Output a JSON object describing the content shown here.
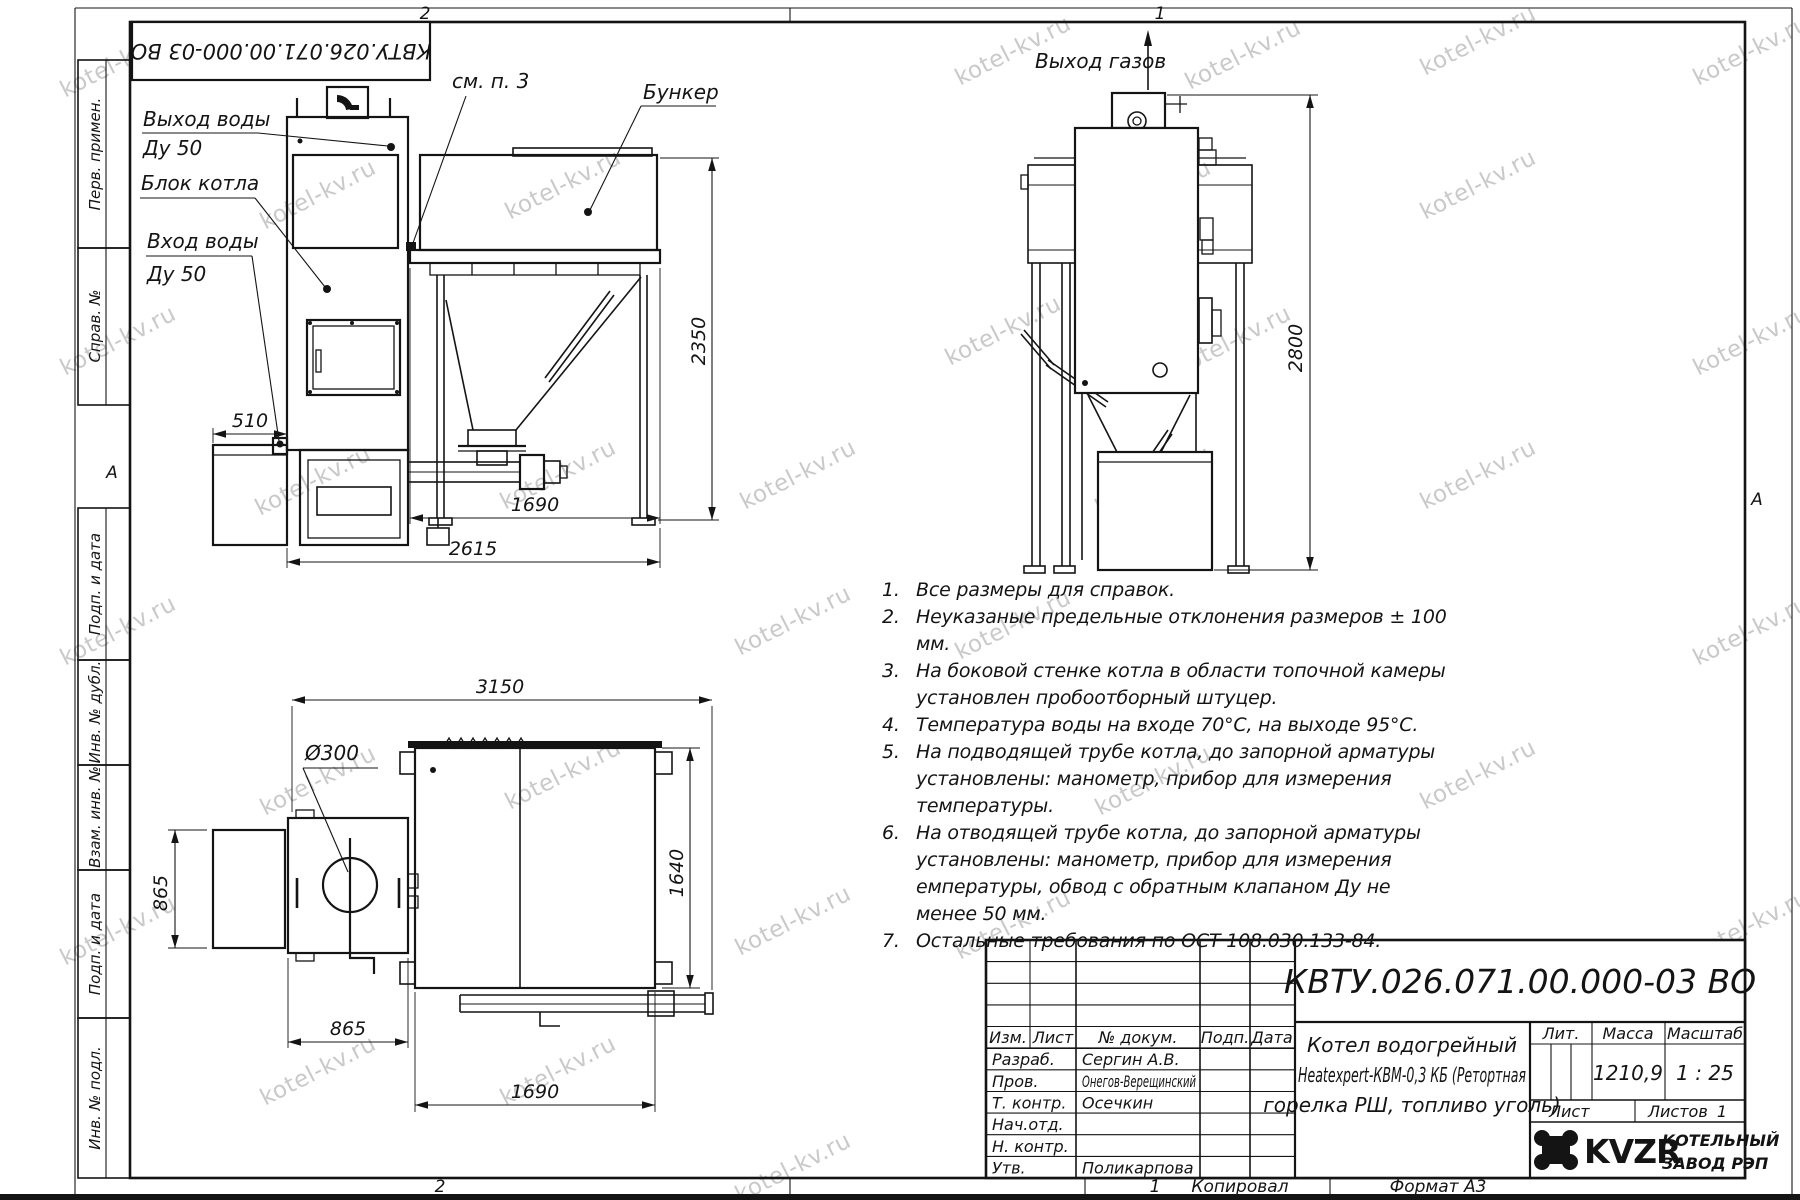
{
  "watermark": {
    "text": "kotel-kv.ru"
  },
  "sheet": {
    "zone_top_left": "2",
    "zone_top_right": "1",
    "zone_bottom_left": "2",
    "zone_bottom_right": "1",
    "fold_mark_left": "А",
    "fold_mark_right": "А",
    "copied": "Копировал",
    "format": "Формат А3",
    "doc_number_flipped": "КВТУ.026.071.00.000-03 ВО"
  },
  "margin_labels": {
    "perv_primen": "Перв. примен.",
    "sprav_no": "Справ. №",
    "podp_i_data_1": "Подп. и дата",
    "inv_no_dubl": "Инв. № дубл.",
    "vzam_inv_no": "Взам. инв. №",
    "podp_i_data_2": "Подп. и дата",
    "inv_no_podl": "Инв. № подл."
  },
  "front_view": {
    "water_out_line1": "Выход воды",
    "water_out_line2": "Ду 50",
    "boiler_block": "Блок котла",
    "water_in_line1": "Вход воды",
    "water_in_line2": "Ду 50",
    "see_note": "см. п. 3",
    "bunker": "Бункер",
    "dim_510": "510",
    "dim_1690": "1690",
    "dim_2615": "2615",
    "dim_2350": "2350"
  },
  "side_view": {
    "gas_out": "Выход газов",
    "dim_2800": "2800"
  },
  "plan_view": {
    "dia_300": "Ø300",
    "dim_3150": "3150",
    "dim_865_v": "865",
    "dim_865_h": "865",
    "dim_1690": "1690",
    "dim_1640": "1640"
  },
  "notes": {
    "items": [
      {
        "num": "1.",
        "text": "Все размеры для справок."
      },
      {
        "num": "2.",
        "text": "Неуказаные предельные отклонения размеров ± 100 мм."
      },
      {
        "num": "3.",
        "text": "На боковой стенке котла в области топочной камеры установлен пробоотборный штуцер."
      },
      {
        "num": "4.",
        "text": "Температура воды на входе 70°С, на выходе 95°С."
      },
      {
        "num": "5.",
        "text": "На подводящей трубе котла, до запорной арматуры установлены: манометр, прибор для измерения температуры."
      },
      {
        "num": "6.",
        "text": "На отводящей трубе котла, до запорной арматуры установлены: манометр, прибор для измерения емпературы, обвод с обратным клапаном Ду не менее 50 мм."
      },
      {
        "num": "7.",
        "text": "Остальные требования по ОСТ 108.030.133-84."
      }
    ]
  },
  "title_block": {
    "doc_number": "КВТУ.026.071.00.000-03 ВО",
    "name_line1": "Котел водогрейный",
    "name_line2": "Heatexpert-КВМ-0,3 КБ (Ретортная",
    "name_line3": "горелка РШ, топливо уголь)",
    "col_izm": "Изм.",
    "col_list": "Лист",
    "col_dokum": "№ докум.",
    "col_podp": "Подп.",
    "col_data": "Дата",
    "row_razrab": "Разраб.",
    "razrab_name": "Сергин А.В.",
    "row_prov": "Пров.",
    "prov_name": "Онегов-Верещинский",
    "row_tkontr": "Т. контр.",
    "tkontr_name": "Осечкин",
    "row_nachotd": "Нач.отд.",
    "row_nkontr": "Н. контр.",
    "row_utv": "Утв.",
    "utv_name": "Поликарпова",
    "lit_label": "Лит.",
    "massa_label": "Масса",
    "masshtab_label": "Масштаб",
    "massa_value": "1210,9",
    "masshtab_value": "1 : 25",
    "list_label": "Лист",
    "listov_label": "Листов",
    "listov_value": "1",
    "logo": "KVZR",
    "company_line1": "КОТЕЛЬНЫЙ",
    "company_line2": "ЗАВОД РЭП"
  }
}
